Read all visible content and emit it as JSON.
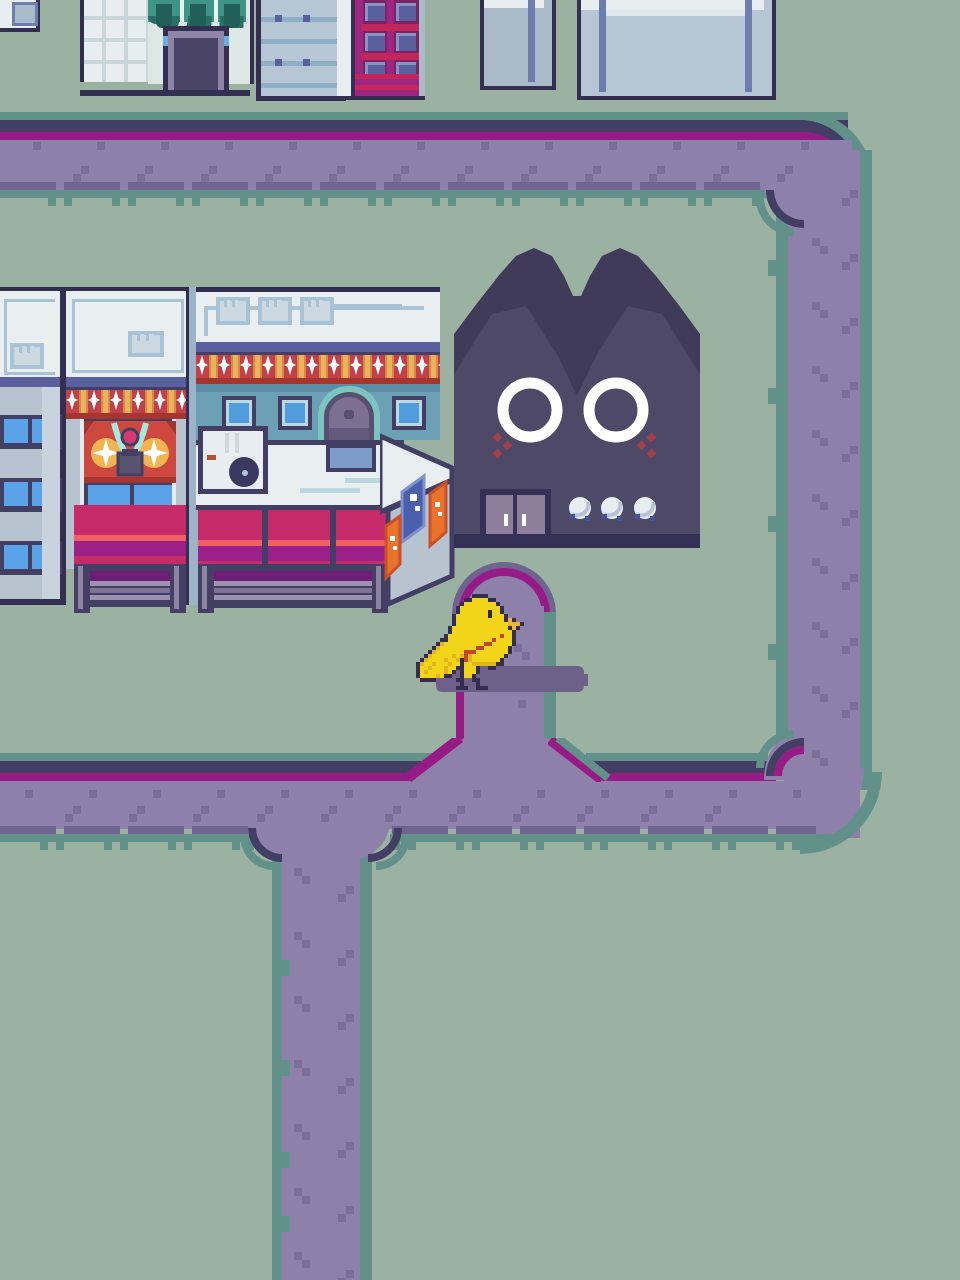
{
  "palette": {
    "bg": "#9bb1a1",
    "teal": "#629189",
    "navy": "#433e63",
    "outline": "#332f51",
    "magenta": "#971b84",
    "path": "#8d81ab",
    "dot": "#7b6f99",
    "shadowPurple": "#6f6390",
    "birdShadow": "#6d6189",
    "white": "#e9eef1",
    "signFrame": "#a9c3d6",
    "blueBand": "#5a5f9e",
    "paleBlue": "#a9bac9",
    "paleBlueB": "#b6c6d4",
    "gridLineB": "#8fb0c4",
    "lightBlueWall": "#b7c3cf",
    "pilaster": "#c9d3dd",
    "brightWindow": "#5ba3e8",
    "windowBlue": "#4f9ddc",
    "windowRing": "#bcd7e0",
    "facadeTeal": "#6ba0b5",
    "facadeTealDark": "#5b8ea6",
    "awnRed": "#c24049",
    "awnGold": "#e8b45c",
    "awnOrange": "#dd8746",
    "awnDarkRed": "#a53531",
    "crimson": "#c62a68",
    "coral": "#ef5f63",
    "deepMagenta": "#9c2186",
    "shutterShadow": "#6f1d75",
    "slatLight": "#9a92b0",
    "slatDark": "#7d7596",
    "postDark": "#453f63",
    "postLight": "#8b84a3",
    "archTeal": "#7cc4c0",
    "doorPurple": "#7d6f92",
    "doorPurpleDark": "#655a7d",
    "doorFrame": "#57506f",
    "greenAwn": "#3f9488",
    "greenAwnDark": "#2a6e68",
    "plant": "#215f58",
    "mintFacade": "#dde8e4",
    "whiteGrid": "#e8eef0",
    "whiteGridLine": "#c9d6da",
    "doorA": "#4a4469",
    "doorALight": "#8d84a8",
    "blueAccent": "#6aaede",
    "cFrameDark": "#7c2366",
    "cFrame": "#9e2580",
    "cCrimson": "#c2265c",
    "cPanel": "#5a5f9e",
    "cPanelLight": "#8592c4",
    "bannerRed": "#cf4840",
    "bannerFold": "#a53531",
    "bannerGold": "#f2b552",
    "bannerTeal": "#a8e8dc",
    "lanternGray": "#5a5370",
    "orb": "#d83a70",
    "plaqueBlue": "#7e9cc8",
    "catDark": "#3f3b58",
    "catFace": "#4f4968",
    "catDoor": "#8d7f9b",
    "catBase": "#353055",
    "blush": "#a04048",
    "knob": "#e8edf2",
    "knobShade": "#b9c2d6",
    "knobBlue": "#44539a",
    "orangeBanner": "#e8732a",
    "orangeBannerDark": "#cc4f28",
    "norenBlue": "#4a5fae",
    "norenLight": "#8090c8"
  },
  "sprites": {
    "bird": {
      "x": 416,
      "y": 594,
      "cell": 4,
      "colors": {
        "o": "#332e50",
        "y": "#f2d519",
        "d": "#e2b51e",
        "g": "#d98f2b",
        "r": "#c8432c",
        "b": "#efb43a",
        "e": "#2c2845",
        "l": "#332e50"
      },
      "rows": [
        "..............oooo............",
        "............ooyyyyoo..........",
        "...........oyyyyyyyyo.........",
        "..........oyyyyyyyyyyo........",
        "..........oyyyyyyyeyyo........",
        ".........oyyyyyyyyeyyyo.......",
        ".........oyyyyyyyyyyyyobo.....",
        ".........oyyyyyyyyyyyyybbbo...",
        "........oyyyyyyyyyyyyyyobo....",
        "........oyyyyyyyyyyyyyyyo.....",
        ".......oyyyyyyyyyyyyyryyo.....",
        "......ooyyyyyyyyyyyryyyyo.....",
        ".....odyyyyyyyyyyrryyyyyo.....",
        "....odyyyyyyyyyrryyyyyyo......",
        "...odyyyyyyyrrryyyyyyyyo......",
        "..odyyyyydydrdyyyyyyyyo.......",
        ".odyyyydyydordyyyyyyyo........",
        "odyydyyydyyoyyddddddoo........",
        "oyydyyydyyooyyyo..oo..........",
        "oydyyyydyo.oyyyo..............",
        "oyyyydyoo..oyyo...............",
        ".oooo.....ol..ol..............",
        "...........l...l..............",
        "..........oll..oll............"
      ]
    }
  },
  "path_dots": [
    [
      33,
      142
    ],
    [
      97,
      142
    ],
    [
      161,
      142
    ],
    [
      225,
      142
    ],
    [
      289,
      142
    ],
    [
      353,
      142
    ],
    [
      417,
      142
    ],
    [
      481,
      142
    ],
    [
      545,
      142
    ],
    [
      609,
      142
    ],
    [
      673,
      142
    ],
    [
      737,
      142
    ],
    [
      801,
      142
    ],
    [
      81,
      166
    ],
    [
      145,
      166
    ],
    [
      209,
      166
    ],
    [
      273,
      166
    ],
    [
      337,
      166
    ],
    [
      401,
      166
    ],
    [
      465,
      166
    ],
    [
      529,
      166
    ],
    [
      593,
      166
    ],
    [
      657,
      166
    ],
    [
      721,
      166
    ],
    [
      785,
      166
    ],
    [
      73,
      174
    ],
    [
      137,
      174
    ],
    [
      201,
      174
    ],
    [
      265,
      174
    ],
    [
      329,
      174
    ],
    [
      393,
      174
    ],
    [
      457,
      174
    ],
    [
      521,
      174
    ],
    [
      585,
      174
    ],
    [
      649,
      174
    ],
    [
      713,
      174
    ],
    [
      777,
      174
    ],
    [
      812,
      238
    ],
    [
      820,
      246
    ],
    [
      812,
      302
    ],
    [
      820,
      310
    ],
    [
      812,
      366
    ],
    [
      820,
      374
    ],
    [
      812,
      430
    ],
    [
      820,
      438
    ],
    [
      812,
      494
    ],
    [
      820,
      502
    ],
    [
      812,
      558
    ],
    [
      820,
      566
    ],
    [
      812,
      622
    ],
    [
      820,
      630
    ],
    [
      812,
      686
    ],
    [
      820,
      694
    ],
    [
      812,
      750
    ],
    [
      820,
      758
    ],
    [
      842,
      198
    ],
    [
      850,
      190
    ],
    [
      842,
      262
    ],
    [
      850,
      254
    ],
    [
      842,
      326
    ],
    [
      850,
      318
    ],
    [
      842,
      390
    ],
    [
      850,
      382
    ],
    [
      842,
      454
    ],
    [
      850,
      446
    ],
    [
      842,
      518
    ],
    [
      850,
      510
    ],
    [
      842,
      582
    ],
    [
      850,
      574
    ],
    [
      842,
      646
    ],
    [
      850,
      638
    ],
    [
      842,
      710
    ],
    [
      850,
      702
    ],
    [
      25,
      790
    ],
    [
      89,
      790
    ],
    [
      153,
      790
    ],
    [
      217,
      790
    ],
    [
      281,
      790
    ],
    [
      345,
      790
    ],
    [
      409,
      790
    ],
    [
      473,
      790
    ],
    [
      537,
      790
    ],
    [
      601,
      790
    ],
    [
      665,
      790
    ],
    [
      729,
      790
    ],
    [
      793,
      790
    ],
    [
      73,
      806
    ],
    [
      137,
      806
    ],
    [
      201,
      806
    ],
    [
      265,
      806
    ],
    [
      329,
      806
    ],
    [
      393,
      806
    ],
    [
      457,
      806
    ],
    [
      521,
      806
    ],
    [
      585,
      806
    ],
    [
      649,
      806
    ],
    [
      713,
      806
    ],
    [
      65,
      814
    ],
    [
      129,
      814
    ],
    [
      193,
      814
    ],
    [
      257,
      814
    ],
    [
      321,
      814
    ],
    [
      385,
      814
    ],
    [
      449,
      814
    ],
    [
      513,
      814
    ],
    [
      577,
      814
    ],
    [
      641,
      814
    ],
    [
      705,
      814
    ],
    [
      294,
      868
    ],
    [
      302,
      876
    ],
    [
      294,
      932
    ],
    [
      302,
      940
    ],
    [
      294,
      996
    ],
    [
      302,
      1004
    ],
    [
      294,
      1060
    ],
    [
      302,
      1068
    ],
    [
      294,
      1124
    ],
    [
      302,
      1132
    ],
    [
      294,
      1188
    ],
    [
      302,
      1196
    ],
    [
      294,
      1252
    ],
    [
      302,
      1260
    ],
    [
      338,
      894
    ],
    [
      346,
      886
    ],
    [
      338,
      958
    ],
    [
      346,
      950
    ],
    [
      338,
      1022
    ],
    [
      346,
      1014
    ],
    [
      338,
      1086
    ],
    [
      346,
      1078
    ],
    [
      338,
      1150
    ],
    [
      346,
      1142
    ],
    [
      338,
      1214
    ],
    [
      346,
      1206
    ],
    [
      338,
      1278
    ],
    [
      346,
      1270
    ],
    [
      514,
      644
    ],
    [
      522,
      652
    ],
    [
      518,
      700
    ],
    [
      478,
      612
    ],
    [
      486,
      620
    ]
  ]
}
